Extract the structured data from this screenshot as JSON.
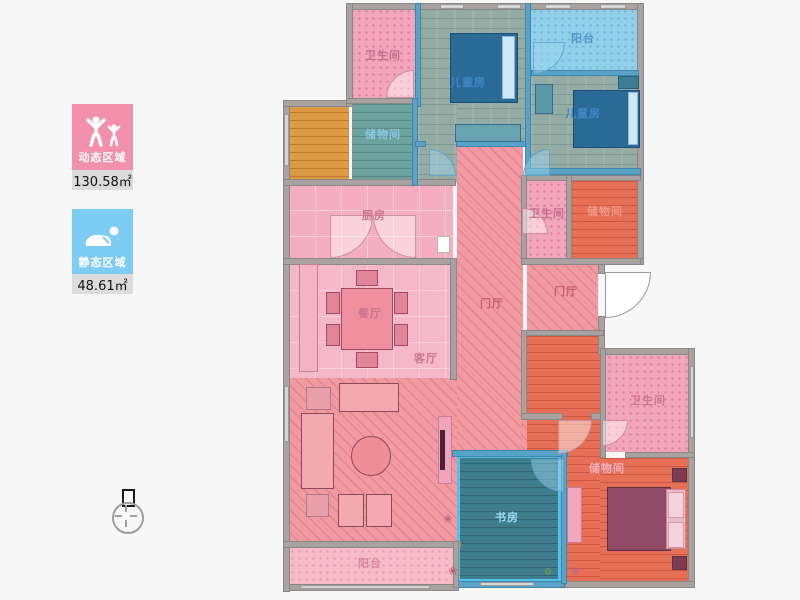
{
  "legend": {
    "dynamic": {
      "label": "动态区域",
      "value": "130.58㎡",
      "color": "#f290ab",
      "icon": "people-raising-arms-icon"
    },
    "static": {
      "label": "静态区域",
      "value": "48.61㎡",
      "color": "#7cccf4",
      "icon": "sleeping-person-icon"
    }
  },
  "rooms": {
    "bath_top": {
      "label": "卫生间"
    },
    "kids_room_1": {
      "label": "儿童房"
    },
    "balcony_top": {
      "label": "阳台"
    },
    "kids_room_2": {
      "label": "儿童房"
    },
    "storage_top": {
      "label": "储物间"
    },
    "kitchen": {
      "label": "厨房"
    },
    "bath_mid": {
      "label": "卫生间"
    },
    "storage_mid": {
      "label": "储物间"
    },
    "foyer_left": {
      "label": "门厅"
    },
    "foyer_right": {
      "label": "门厅"
    },
    "dining": {
      "label": "餐厅"
    },
    "living": {
      "label": "客厅"
    },
    "study": {
      "label": "书房"
    },
    "storage_bottom": {
      "label": "储物间"
    },
    "bath_bottom": {
      "label": "卫生间"
    },
    "balcony_bottom": {
      "label": "阳台"
    }
  },
  "colors": {
    "dynamic_zone_pink": "#f290ab",
    "static_zone_blue": "#7cccf4",
    "wall_gray": "#a8a3a0",
    "wall_blue": "#5aa3c8",
    "living_hatch": "#f29aa2",
    "storage_red": "#e66f56",
    "study_teal": "#3e7e8c",
    "balcony_blue": "#92cfe9",
    "wood_orange": "#dc9a42"
  }
}
